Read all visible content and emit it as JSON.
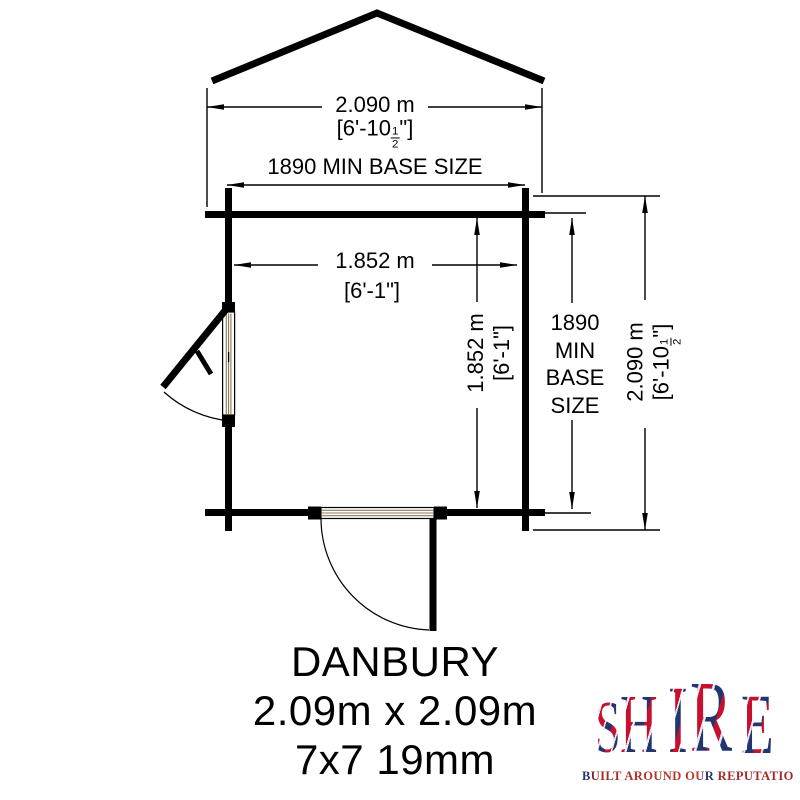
{
  "colors": {
    "ink": "#000000",
    "timber_hatch": "#8b7a58",
    "logo_red": "#c8102e",
    "logo_blue": "#22356f"
  },
  "dimensions": {
    "overall_width": {
      "metric": "2.090 m",
      "imperial_prefix": "[6'-10",
      "fraction_numerator": "1",
      "fraction_denominator": "2",
      "imperial_suffix": "\"]"
    },
    "min_base_horizontal": {
      "label": "1890 MIN BASE SIZE"
    },
    "internal_width": {
      "metric": "1.852 m",
      "imperial": "[6'-1\"]"
    },
    "internal_depth": {
      "metric": "1.852 m",
      "imperial": "[6'-1\"]"
    },
    "min_base_vertical": {
      "lines": [
        "1890",
        "MIN",
        "BASE",
        "SIZE"
      ]
    },
    "overall_depth": {
      "metric": "2.090 m",
      "imperial_prefix": "[6'-10",
      "fraction_numerator": "1",
      "fraction_denominator": "2",
      "imperial_suffix": "\"]"
    }
  },
  "product": {
    "name": "DANBURY",
    "footprint": "2.09m x 2.09m",
    "spec": "7x7 19mm"
  },
  "logo": {
    "letters": [
      "S",
      "H",
      "I",
      "R",
      "E"
    ],
    "tagline": "BUILT AROUND OUR REPUTATION"
  }
}
